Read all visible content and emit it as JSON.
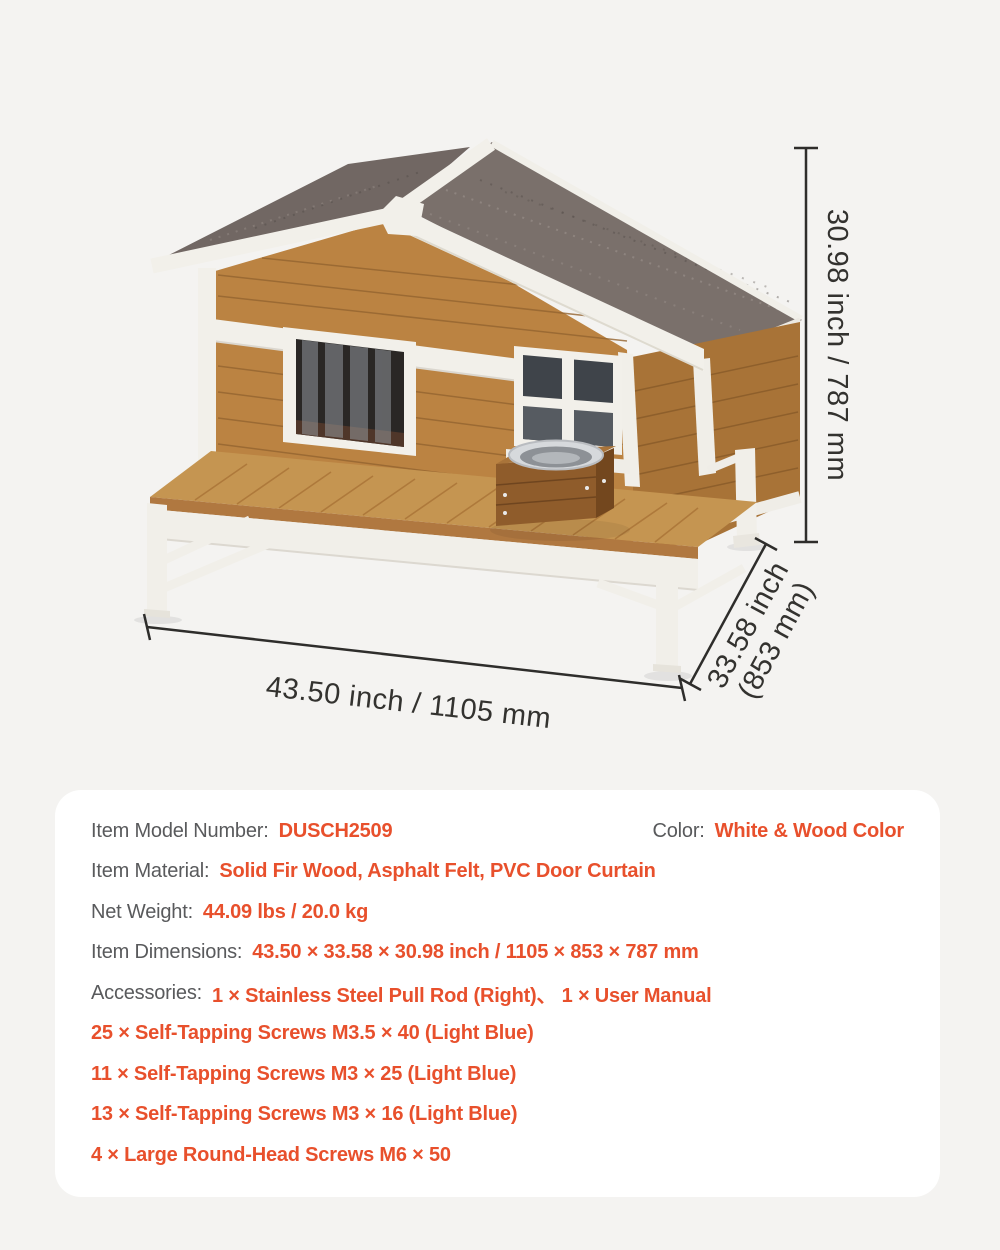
{
  "product_diagram": {
    "dimension_labels": {
      "width": "43.50 inch / 1105 mm",
      "depth_line1": "33.58 inch",
      "depth_line2": "(853 mm)",
      "height": "30.98 inch / 787 mm"
    },
    "colors": {
      "accent_orange": "#e8502c",
      "label_gray": "#595a5c",
      "page_background": "#f4f3f1",
      "card_background": "#ffffff",
      "wood": "#bb8342",
      "deck_wood": "#c59551",
      "trim_white": "#f2f0ea",
      "roof_asphalt": "#7a706b",
      "dimension_line": "#2e2d2b"
    }
  },
  "spec_card": {
    "rows": [
      {
        "label": "Item Model Number:",
        "value": "DUSCH2509"
      },
      {
        "label": "Color:",
        "value": "White & Wood Color"
      },
      {
        "label": "Item Material:",
        "value": "Solid Fir Wood, Asphalt Felt, PVC Door Curtain"
      },
      {
        "label": "Net Weight:",
        "value": "44.09 lbs / 20.0 kg"
      },
      {
        "label": "Item Dimensions:",
        "value": "43.50 × 33.58 × 30.98 inch / 1105 × 853 × 787 mm"
      },
      {
        "label": "Accessories:",
        "value": "1 × Stainless Steel Pull Rod (Right)、 1 × User Manual"
      },
      {
        "label": "",
        "value": "25 × Self-Tapping Screws M3.5 × 40 (Light Blue)"
      },
      {
        "label": "",
        "value": "11 × Self-Tapping Screws M3 × 25 (Light Blue)"
      },
      {
        "label": "",
        "value": "13 × Self-Tapping Screws M3 × 16 (Light Blue)"
      },
      {
        "label": "",
        "value": "4 × Large Round-Head Screws M6 × 50"
      }
    ]
  }
}
